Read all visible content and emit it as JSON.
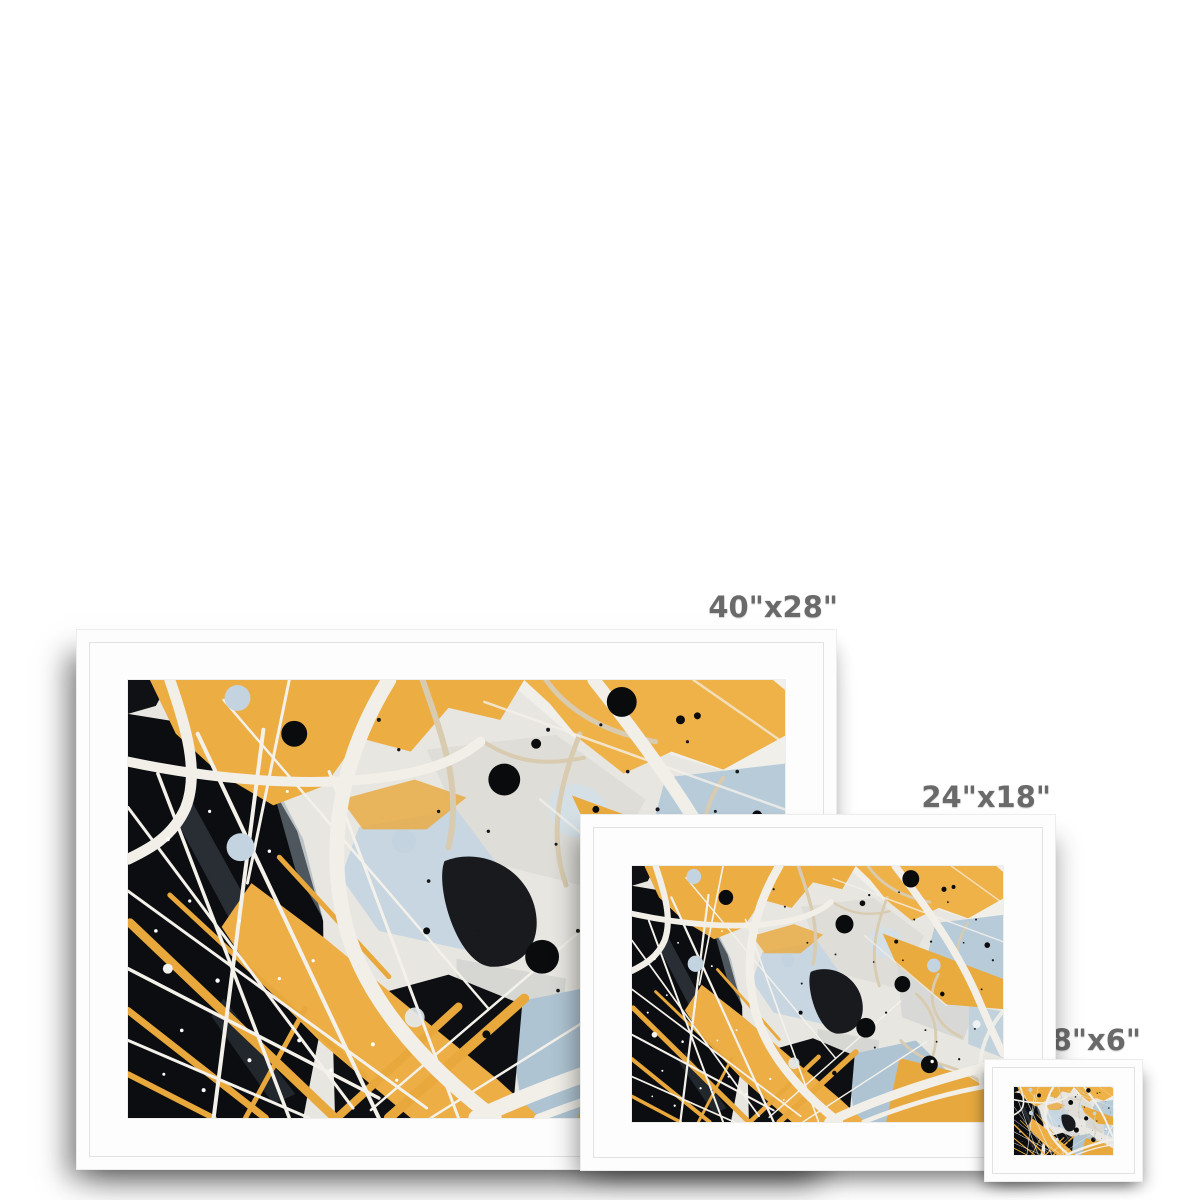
{
  "page": {
    "background_color": "#ffffff"
  },
  "frames": [
    {
      "id": "large",
      "size_label": "40\"x28\""
    },
    {
      "id": "medium",
      "size_label": "24\"x18\""
    },
    {
      "id": "small",
      "size_label": "8\"x6\""
    }
  ],
  "style": {
    "label_color": "#6a6a6a",
    "frame_color": "#fdfdfd",
    "mat_color": "#ffffff"
  },
  "artwork": {
    "name": "abstract-gold-black-splatter-painting",
    "colors": {
      "gold": "#ecad42",
      "black": "#0c0d10",
      "silver": "#e8e6e1",
      "blue_gray": "#b8cbd9",
      "cream_line": "#f1efe8"
    }
  }
}
